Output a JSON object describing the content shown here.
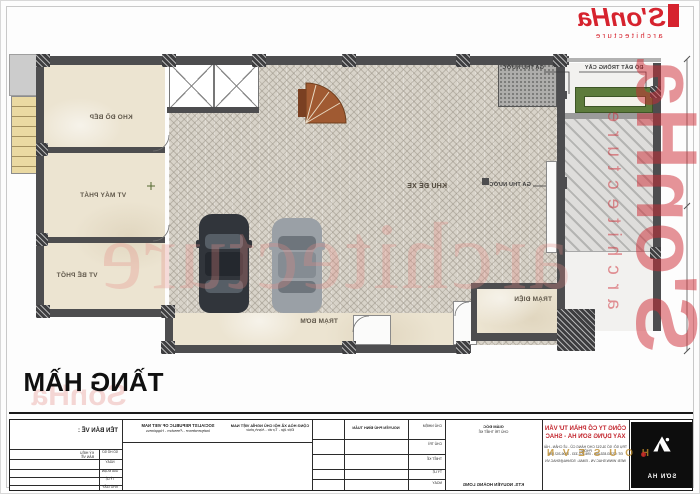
{
  "logo": {
    "brand": "S'onHa",
    "tagline": "architecture"
  },
  "title": {
    "text": "TẦNG HẦM"
  },
  "watermark": {
    "vertical_brand": "S'onHa",
    "vertical_tagline": "architecture",
    "middle": "architecture",
    "title_echo": "SonHa",
    "gold": "H O U S E V N"
  },
  "plan": {
    "labels": [
      "KHO ĐỒ BẾP",
      "VT MÁY PHÁT",
      "VT BỂ PHỐT",
      "KHU ĐỂ XE",
      "TRẠM BƠM",
      "TRẠM ĐIỆN",
      "GA THU NƯỚC",
      "ĐỔ ĐẤT TRỒNG CÂY",
      "GA THU NƯỚC"
    ]
  },
  "titleblock": {
    "ten_ban_ve": "TÊN BẢN VẼ :",
    "left_note_1": "KÝ HIỆU",
    "left_note_2": "BẢN VẼ",
    "row_labels": [
      "SỐ HỒ SƠ",
      "NGÀY",
      "GIAI ĐOẠN",
      "TỶ LỆ",
      "KHỔ GIẤY"
    ],
    "republic_en_1": "SOCIALIST REPUBLIC OF VIET NAM",
    "republic_en_2": "Independence - Freedom - Happiness",
    "republic_vn_1": "CỘNG HÒA XÃ HỘI CHỦ NGHĨA VIỆT NAM",
    "republic_vn_2": "Độc lập - Tự do - Hạnh phúc",
    "designer": "NGUYỄN PHÚ ĐÌNH TUẤN",
    "role_labels": [
      "CHỦ NHIỆM",
      "CHỦ TRÌ",
      "THIẾT KẾ",
      "TỶ LỆ",
      "NGÀY"
    ],
    "director_role": "GIÁM ĐỐC",
    "director_role2": "CHỦ TRÌ THIẾT KẾ",
    "director_name": "KTS. NGUYỄN HOÀNG LONG",
    "company_line1": "CÔNG TY CỔ PHẦN TƯ VẤN",
    "company_line2": "XÂY DỰNG SƠN HÀ - SHAC",
    "company_line3": "TRỤ SỞ: SỐ 31/212 CHỢ HÀNG CŨ - LÊ CHÂN - HẢI PHÒNG",
    "company_line4": "ĐT: 02253.833.666 - 096.202.333 - 0906.202.555",
    "company_line5": "WEB: WWW.SHAC.VN - EMAIL: SONHA@SHAC.VN",
    "logo_text": "SƠN HÀ"
  },
  "colors": {
    "brand_red": "#d6232e",
    "wall": "#4d4d4f",
    "floor_cream": "#ece4d1",
    "planter_green": "#5d7b3c"
  }
}
